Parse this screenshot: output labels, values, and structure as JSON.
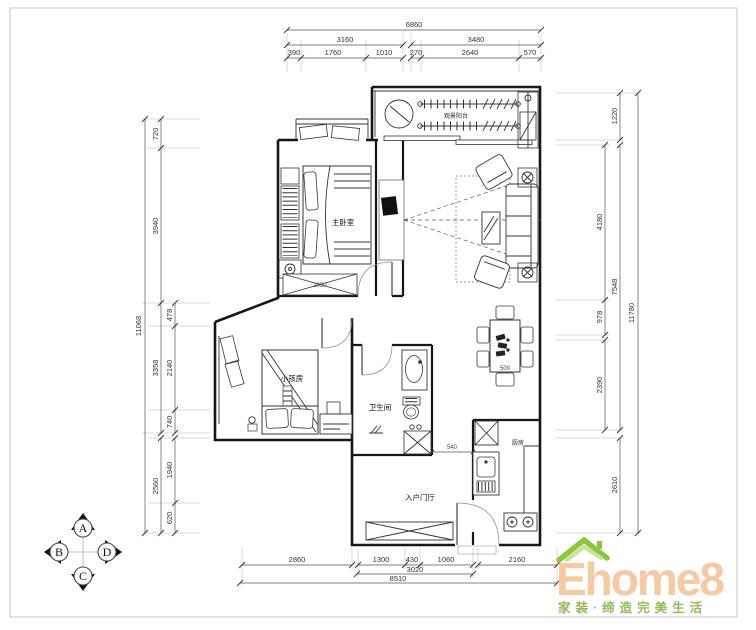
{
  "rooms": {
    "master_bedroom": "主卧室",
    "kids_room": "小孩房",
    "bathroom": "卫生间",
    "entry_hall": "入户门厅",
    "kitchen": "厨房",
    "balcony": "观景阳台"
  },
  "dimensions": {
    "top": {
      "total": "6860",
      "groups": [
        "3160",
        "3480"
      ],
      "segments": [
        "390",
        "1760",
        "1010",
        "270",
        "2640",
        "570"
      ]
    },
    "left": {
      "total": "11068",
      "mid": [
        "720",
        "3940",
        "3358",
        "2560"
      ],
      "inner": [
        "478",
        "2140",
        "740",
        "1940",
        "620"
      ]
    },
    "right": {
      "total": "11780",
      "mid": [
        "1220",
        "7548",
        "2610"
      ],
      "inner": [
        "4180",
        "978",
        "2390"
      ]
    },
    "bottom": {
      "total": "8510",
      "mid": "3020",
      "segments": [
        "2860",
        "1300",
        "430",
        "1060",
        "2160"
      ]
    },
    "interior": {
      "wardrobe": "2050",
      "dining_table": "500",
      "hallway": "540"
    }
  },
  "compass": {
    "north": "A",
    "west": "B",
    "south": "C",
    "east": "D"
  },
  "logo": {
    "brand": "Ehome8",
    "tagline": "家装·缔造完美生活",
    "brand_color": "#f5c9a1",
    "tagline_color": "#93b958",
    "roof_color": "#8cc63f",
    "roof_light_color": "#cbe29b"
  },
  "colors": {
    "wall": "#161616",
    "dimension": "#555555",
    "paper": "#ffffff"
  }
}
